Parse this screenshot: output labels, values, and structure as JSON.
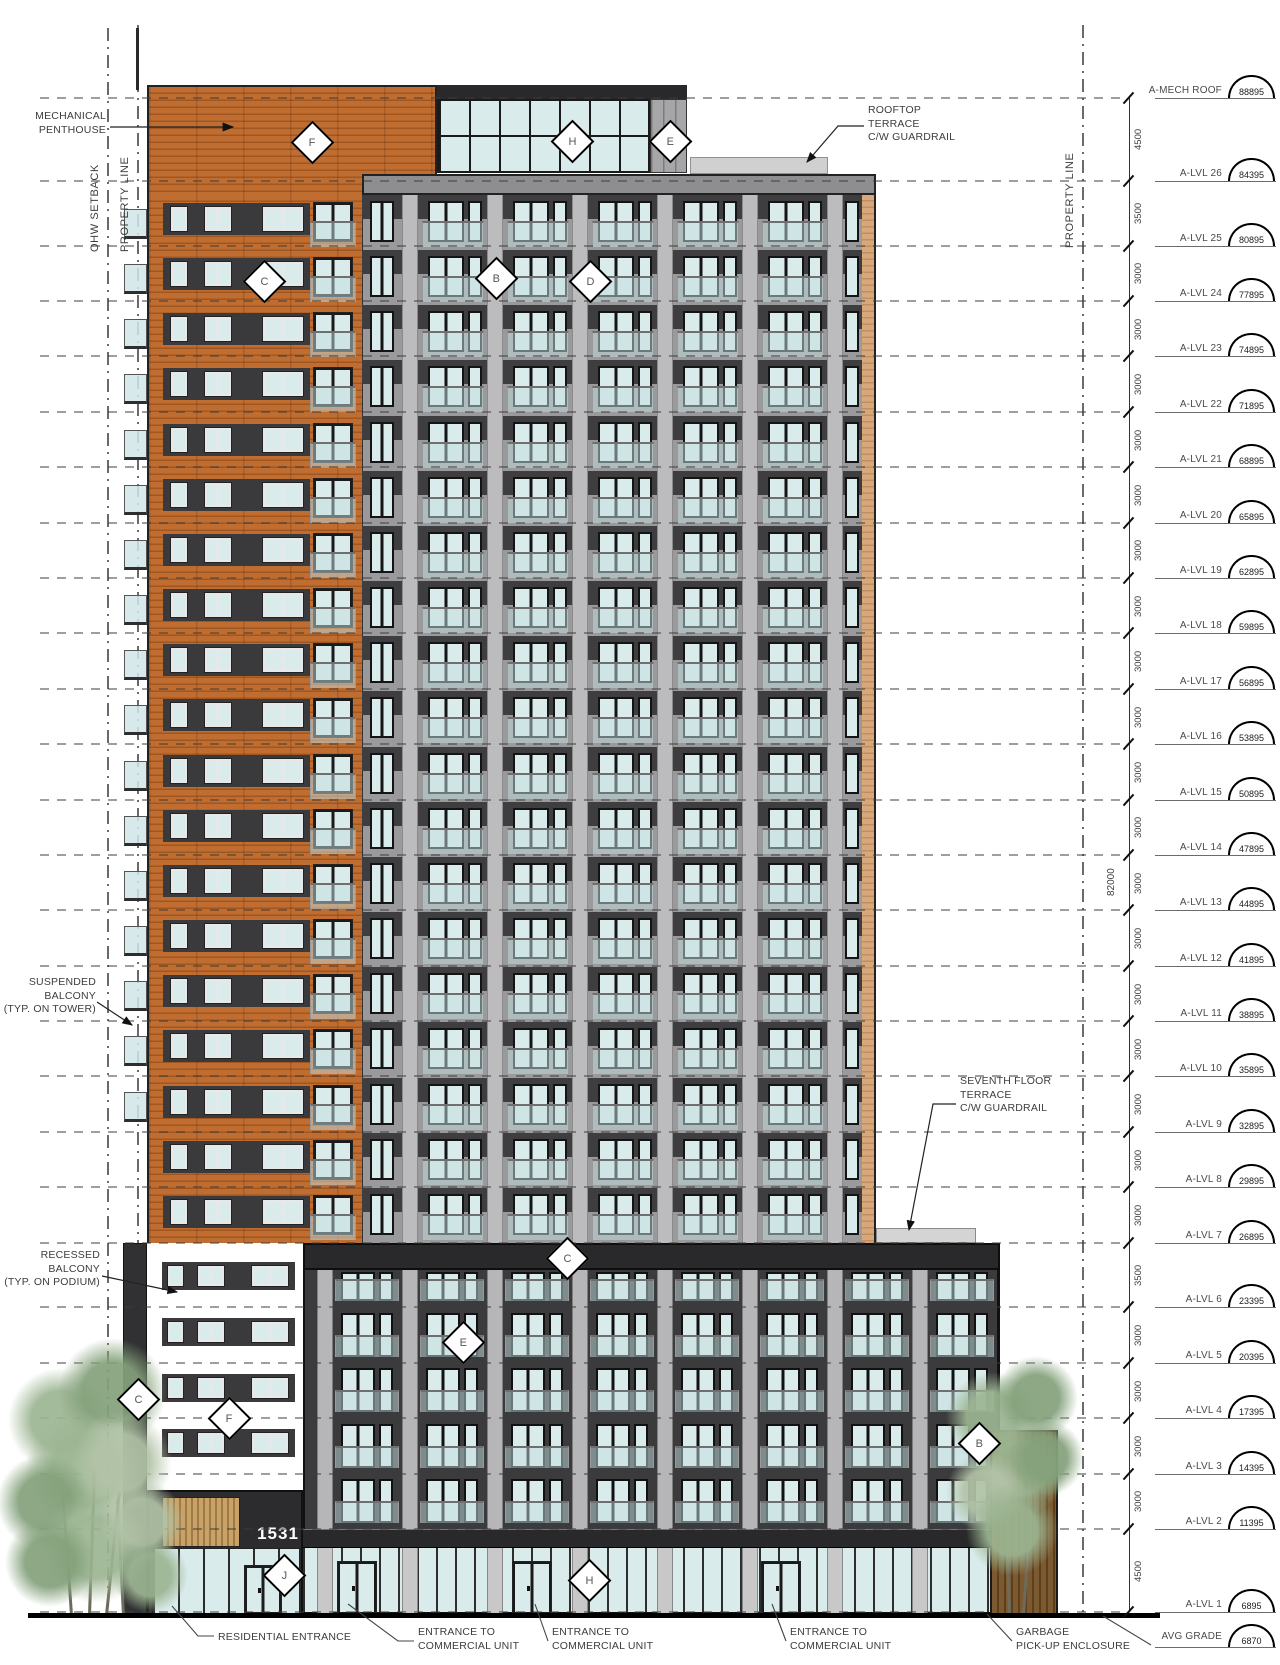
{
  "drawing": {
    "reference_lines": {
      "left_outer": "OHW SETBACK",
      "left_inner": "PROPERTY LINE",
      "right": "PROPERTY LINE"
    },
    "overall_height_dim": "82000",
    "levels": [
      {
        "name": "A-MECH ROOF",
        "elev": 88895
      },
      {
        "name": "A-LVL 26",
        "elev": 84395
      },
      {
        "name": "A-LVL 25",
        "elev": 80895
      },
      {
        "name": "A-LVL 24",
        "elev": 77895
      },
      {
        "name": "A-LVL 23",
        "elev": 74895
      },
      {
        "name": "A-LVL 22",
        "elev": 71895
      },
      {
        "name": "A-LVL 21",
        "elev": 68895
      },
      {
        "name": "A-LVL 20",
        "elev": 65895
      },
      {
        "name": "A-LVL 19",
        "elev": 62895
      },
      {
        "name": "A-LVL 18",
        "elev": 59895
      },
      {
        "name": "A-LVL 17",
        "elev": 56895
      },
      {
        "name": "A-LVL 16",
        "elev": 53895
      },
      {
        "name": "A-LVL 15",
        "elev": 50895
      },
      {
        "name": "A-LVL 14",
        "elev": 47895
      },
      {
        "name": "A-LVL 13",
        "elev": 44895
      },
      {
        "name": "A-LVL 12",
        "elev": 41895
      },
      {
        "name": "A-LVL 11",
        "elev": 38895
      },
      {
        "name": "A-LVL 10",
        "elev": 35895
      },
      {
        "name": "A-LVL 9",
        "elev": 32895
      },
      {
        "name": "A-LVL 8",
        "elev": 29895
      },
      {
        "name": "A-LVL 7",
        "elev": 26895
      },
      {
        "name": "A-LVL 6",
        "elev": 23395
      },
      {
        "name": "A-LVL 5",
        "elev": 20395
      },
      {
        "name": "A-LVL 4",
        "elev": 17395
      },
      {
        "name": "A-LVL 3",
        "elev": 14395
      },
      {
        "name": "A-LVL 2",
        "elev": 11395
      },
      {
        "name": "A-LVL 1",
        "elev": 6895
      }
    ],
    "avg_grade": {
      "name": "AVG GRADE",
      "elev": 6870
    },
    "building_number": "1531",
    "annotations": {
      "mechanical_penthouse": "MECHANICAL\nPENTHOUSE",
      "rooftop_terrace": "ROOFTOP\nTERRACE\nC/W GUARDRAIL",
      "suspended_balcony": "SUSPENDED\nBALCONY\n(TYP. ON TOWER)",
      "recessed_balcony": "RECESSED\nBALCONY\n(TYP. ON PODIUM)",
      "seventh_floor_terrace": "SEVENTH FLOOR\nTERRACE\nC/W GUARDRAIL",
      "residential_entrance": "RESIDENTIAL ENTRANCE",
      "commercial_entrance": "ENTRANCE TO\nCOMMERCIAL UNIT",
      "garbage": "GARBAGE\nPICK-UP ENCLOSURE"
    },
    "markers": [
      {
        "letter": "F",
        "x": 310,
        "y": 140
      },
      {
        "letter": "H",
        "x": 570,
        "y": 139
      },
      {
        "letter": "E",
        "x": 668,
        "y": 139
      },
      {
        "letter": "C",
        "x": 262,
        "y": 279
      },
      {
        "letter": "B",
        "x": 494,
        "y": 276
      },
      {
        "letter": "D",
        "x": 588,
        "y": 279
      },
      {
        "letter": "C",
        "x": 565,
        "y": 1256
      },
      {
        "letter": "E",
        "x": 461,
        "y": 1340
      },
      {
        "letter": "B",
        "x": 977,
        "y": 1441
      },
      {
        "letter": "C",
        "x": 136,
        "y": 1397
      },
      {
        "letter": "F",
        "x": 227,
        "y": 1416
      },
      {
        "letter": "J",
        "x": 282,
        "y": 1573
      },
      {
        "letter": "H",
        "x": 587,
        "y": 1578
      }
    ],
    "colors": {
      "brick_orange": "#bf6b2e",
      "panel_gray": "#9a9a9c",
      "pilaster_gray": "#bcbcbe",
      "spandrel_dark": "#3e3e40",
      "podium_dark": "#3b3b3d",
      "parapet_dark": "#29292b",
      "glass": "#d9ebeb",
      "balcony_glass": "rgba(196,221,223,0.5)",
      "wood": "#c9a268",
      "enclosure_wood": "#7c5a31",
      "tree_green": "#9cb592",
      "tan_return": "#d8a87c"
    }
  }
}
